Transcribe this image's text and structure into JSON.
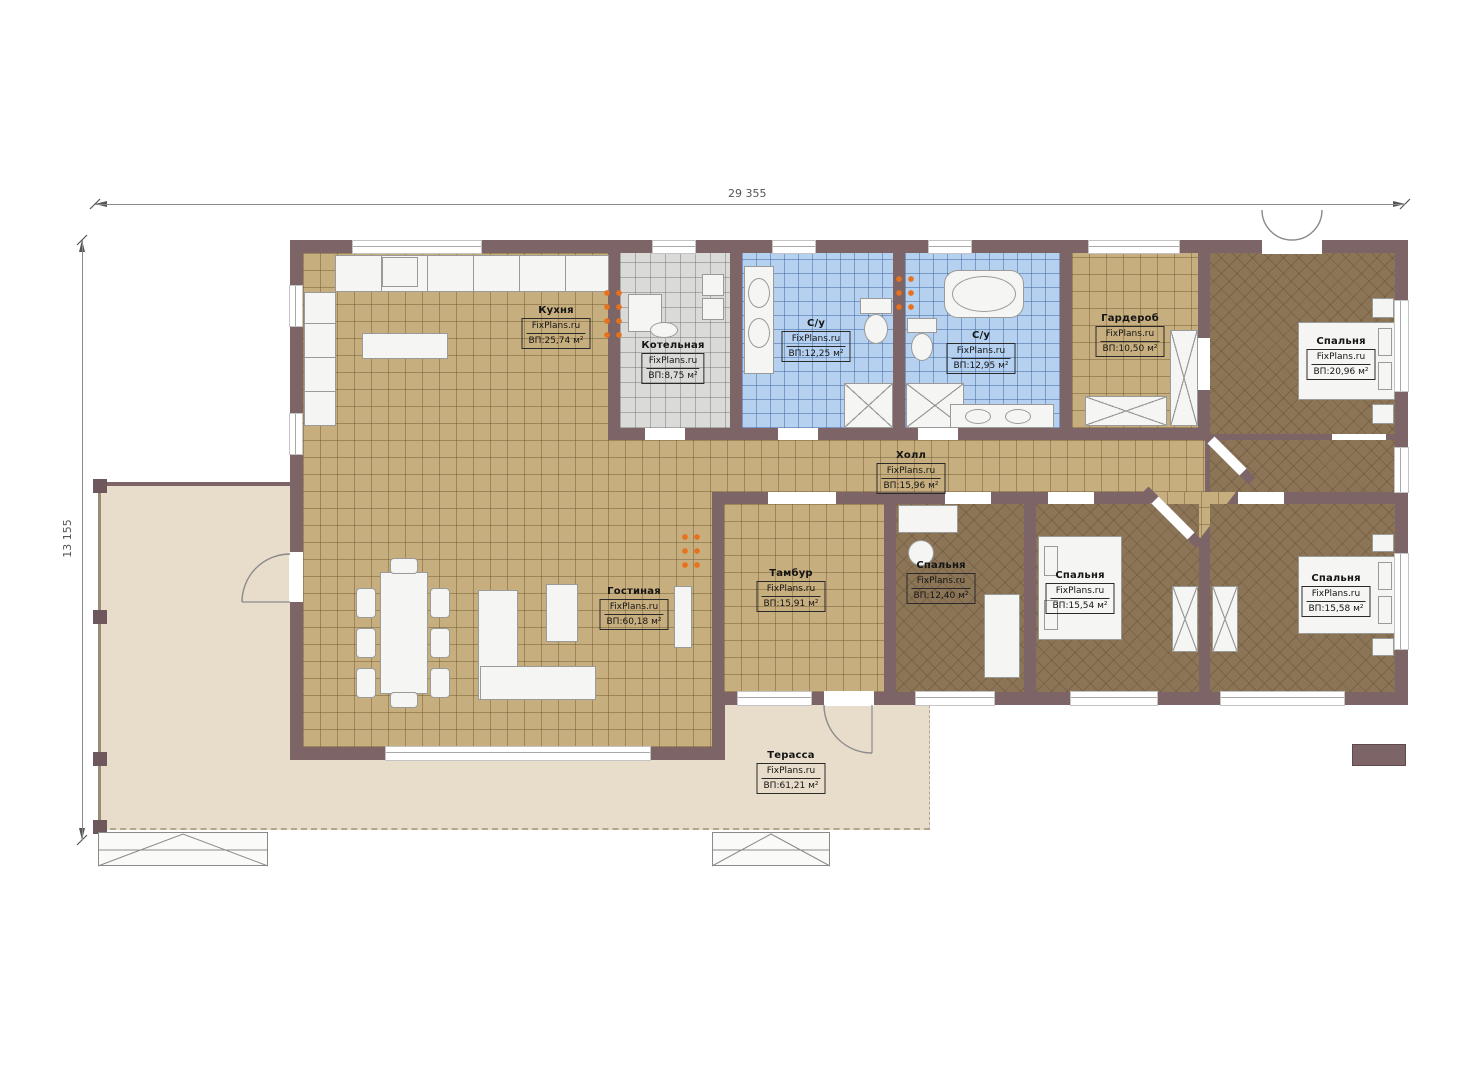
{
  "plan": {
    "watermark": "FixPlans.ru",
    "dimensions": {
      "width_mm": "29 355",
      "height_mm": "13 155"
    },
    "rooms": [
      {
        "id": "kitchen",
        "name": "Кухня",
        "area": "ВП:25,74 м²",
        "x": 556,
        "y": 305
      },
      {
        "id": "boiler",
        "name": "Котельная",
        "area": "ВП:8,75 м²",
        "x": 673,
        "y": 340
      },
      {
        "id": "bathroom-1",
        "name": "С/у",
        "area": "ВП:12,25 м²",
        "x": 816,
        "y": 318
      },
      {
        "id": "bathroom-2",
        "name": "С/у",
        "area": "ВП:12,95 м²",
        "x": 981,
        "y": 330
      },
      {
        "id": "wardrobe",
        "name": "Гардероб",
        "area": "ВП:10,50 м²",
        "x": 1130,
        "y": 313
      },
      {
        "id": "bedroom-1",
        "name": "Спальня",
        "area": "ВП:20,96 м²",
        "x": 1341,
        "y": 336
      },
      {
        "id": "hall",
        "name": "Холл",
        "area": "ВП:15,96 м²",
        "x": 911,
        "y": 450
      },
      {
        "id": "tambour",
        "name": "Тамбур",
        "area": "ВП:15,91 м²",
        "x": 791,
        "y": 568
      },
      {
        "id": "bedroom-2",
        "name": "Спальня",
        "area": "ВП:12,40 м²",
        "x": 941,
        "y": 560
      },
      {
        "id": "bedroom-3",
        "name": "Спальня",
        "area": "ВП:15,54 м²",
        "x": 1080,
        "y": 570
      },
      {
        "id": "bedroom-4",
        "name": "Спальня",
        "area": "ВП:15,58 м²",
        "x": 1336,
        "y": 573
      },
      {
        "id": "living",
        "name": "Гостиная",
        "area": "ВП:60,18 м²",
        "x": 634,
        "y": 586
      },
      {
        "id": "terrace",
        "name": "Терасса",
        "area": "ВП:61,21 м²",
        "x": 791,
        "y": 750
      }
    ],
    "colors": {
      "wall": "#7C6467",
      "tile_tan": "#C7AE7E",
      "tile_gray": "#DADAD8",
      "tile_blue": "#B6D1EF",
      "floor_brown": "#8C7456",
      "terrace": "#E8DCCA",
      "radiator": "#E8721C"
    }
  }
}
